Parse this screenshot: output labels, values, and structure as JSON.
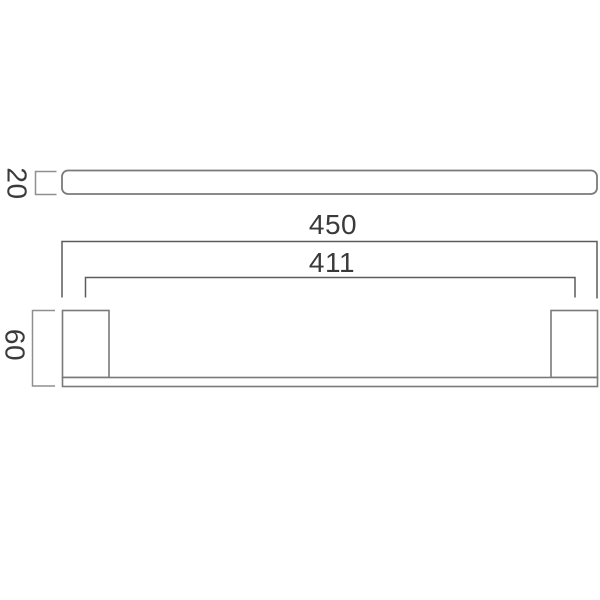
{
  "drawing": {
    "title": "towel-rail-dimension-drawing",
    "dimensions": {
      "overall_width": "450",
      "fixing_centres": "411",
      "bracket_height": "60",
      "rail_depth": "20"
    },
    "colors": {
      "object_line": "#7a7a7a",
      "dimension_line": "#5c5c5c",
      "bracket_line": "#8f8f8f",
      "text": "#3a3a3a",
      "background": "#ffffff"
    }
  }
}
